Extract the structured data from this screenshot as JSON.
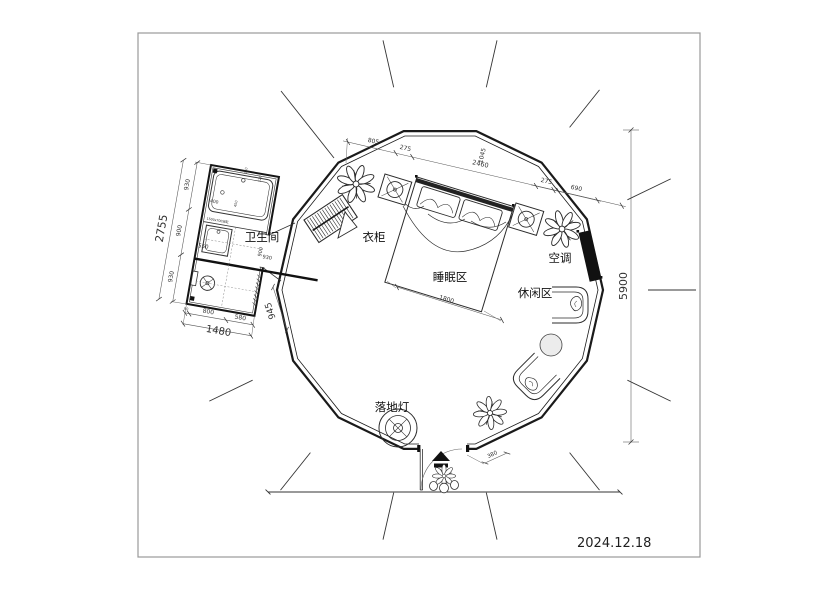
{
  "meta": {
    "date": "2024.12.18"
  },
  "labels": {
    "bathroom": "卫生间",
    "wardrobe": "衣柜",
    "sleeping_area": "睡眠区",
    "lounge_area": "休闲区",
    "air_conditioner": "空调",
    "floor_lamp": "落地灯"
  },
  "dimensions": {
    "tent_height": "5900",
    "annex_height_total": "2755",
    "annex_left_segments": [
      "930",
      "900",
      "930"
    ],
    "annex_width_total": "1480",
    "annex_bottom_segments": [
      "90",
      "800",
      "580"
    ],
    "annex_right_side": "945",
    "sink_width": "550",
    "bathroom_inner_v": "900",
    "bathroom_inner_h": "930",
    "tub_offset": "400",
    "tiny_marks": [
      "450",
      "150",
      "120"
    ],
    "tub_note": "1500x700浴缸",
    "top_chain": [
      "805",
      "275",
      "2460"
    ],
    "top_chain_rotated": "1045",
    "right_chain": [
      "275",
      "690"
    ],
    "bed_width": "1800",
    "door_clearance": "380"
  },
  "colors": {
    "line": "#2a2a2a",
    "wall": "#1a1a1a",
    "solid_fill": "#111111",
    "dim": "#444444",
    "frame": "#999999",
    "background": "#ffffff"
  }
}
